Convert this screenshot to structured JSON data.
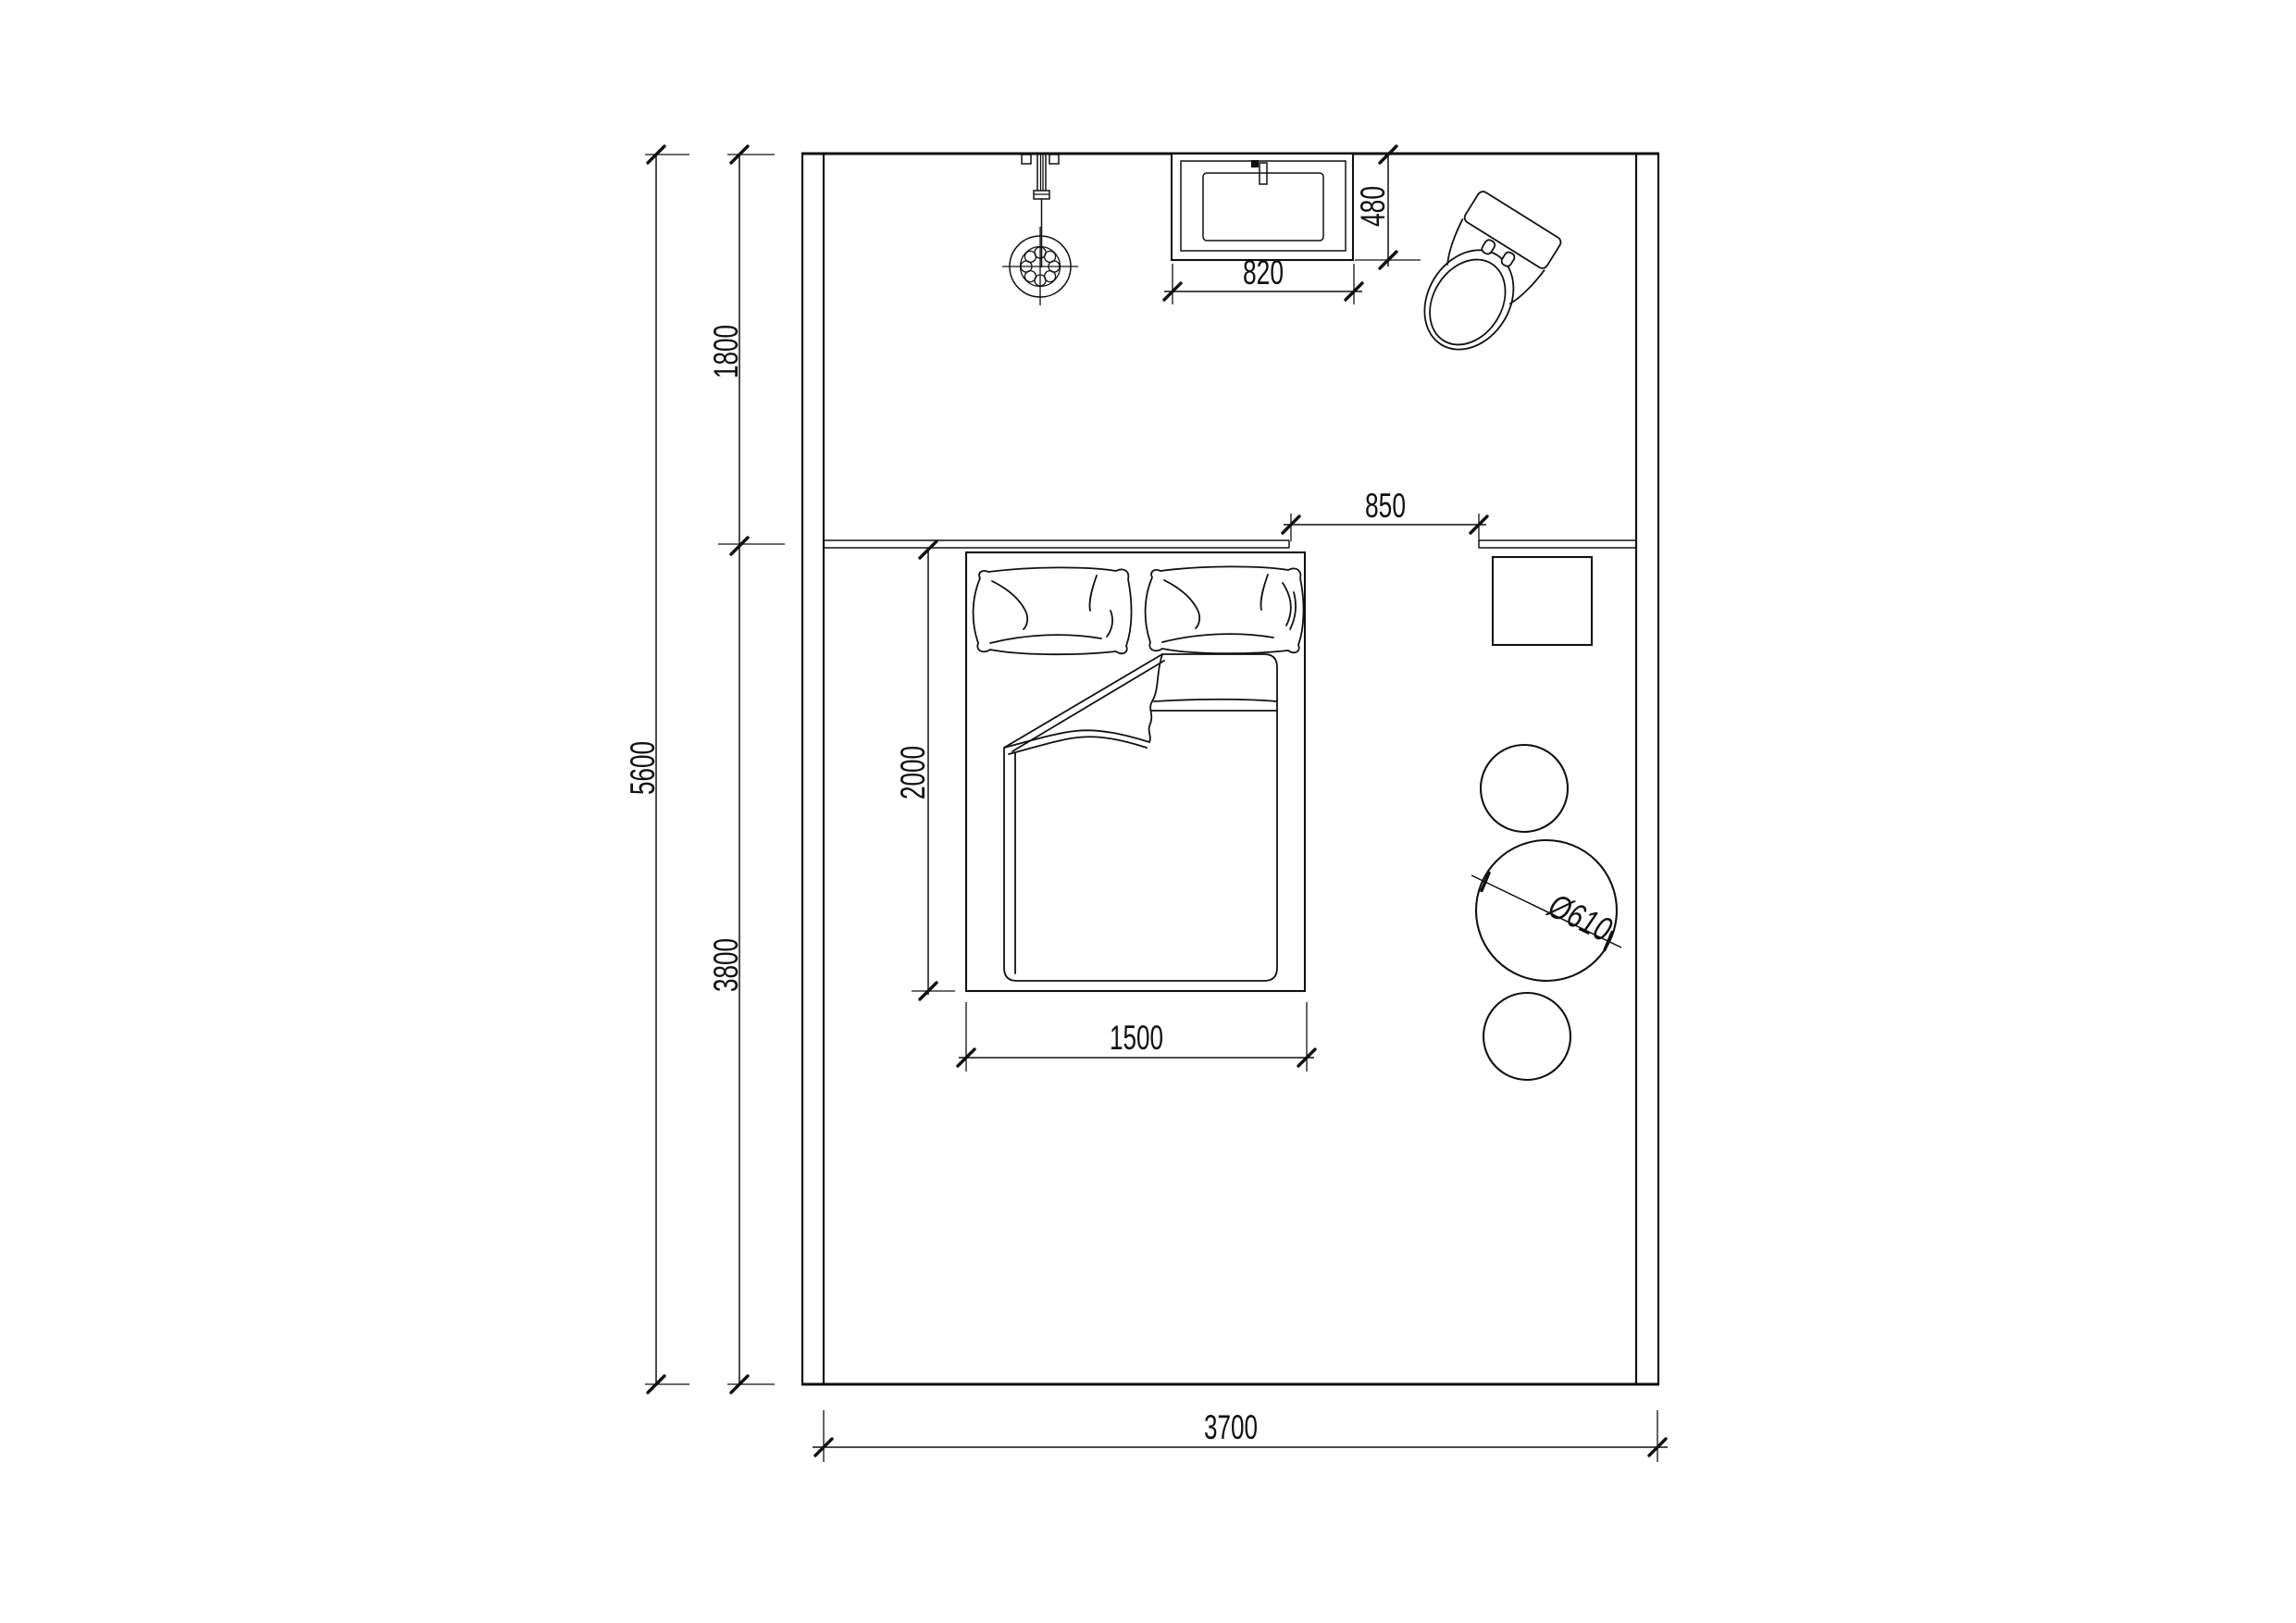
{
  "colors": {
    "line": "#111111",
    "background": "#ffffff"
  },
  "dimensions": {
    "upper_section_height": "1800",
    "total_height": "5600",
    "lower_section_height": "3800",
    "bed_length": "2000",
    "bed_width": "1500",
    "room_width": "3700",
    "washbasin_width": "820",
    "washbasin_depth": "480",
    "bed_to_sideboard_gap": "850",
    "round_table_diameter": "Ø610"
  }
}
